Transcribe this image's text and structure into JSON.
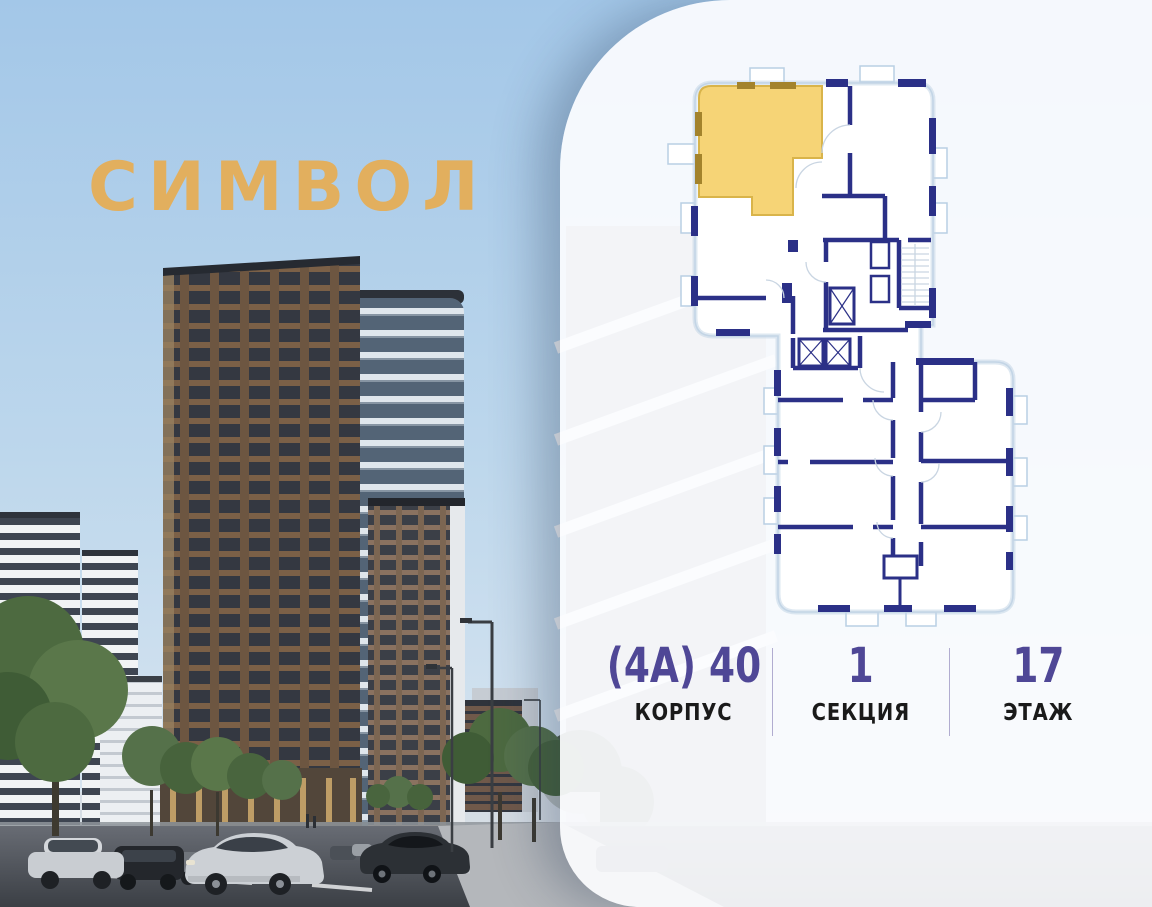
{
  "brand": {
    "logo_text": "СИМВОЛ",
    "logo_color": "#E2AF5E"
  },
  "floorplan": {
    "highlight_color": "#F6D476",
    "highlight_outline_color": "#D9B44A",
    "highlight_window_color": "#A3832C",
    "wall_color": "#2B3087",
    "outline_color": "#C3D5E6",
    "door_color": "#C9D5E2"
  },
  "details": {
    "value_color": "#4F4796",
    "label_color": "#1A1A1A",
    "separator_color": "#8B82B8",
    "building": {
      "value": "(4А) 40",
      "label": "КОРПУС"
    },
    "section": {
      "value": "1",
      "label": "СЕКЦИЯ"
    },
    "floor": {
      "value": "17",
      "label": "ЭТАЖ"
    }
  }
}
